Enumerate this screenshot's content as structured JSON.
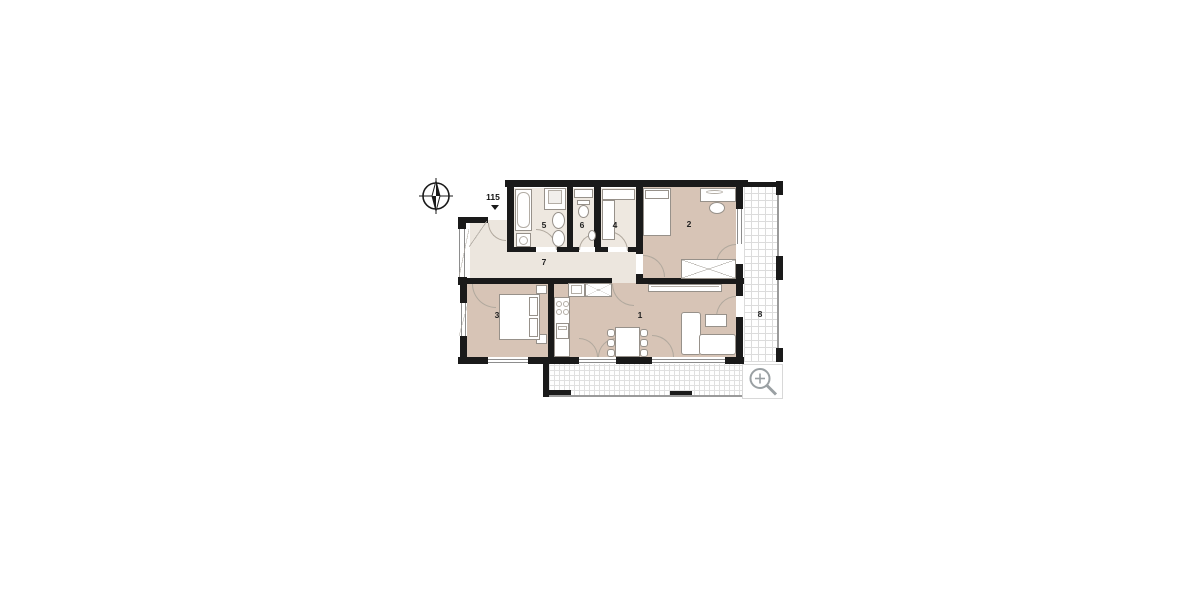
{
  "page": {
    "type": "apartment floor plan drawing",
    "background": "#ffffff"
  },
  "unit": {
    "number": "115"
  },
  "rooms": [
    {
      "key": "living-room",
      "label": "1"
    },
    {
      "key": "bedroom-main",
      "label": "2"
    },
    {
      "key": "bedroom-second",
      "label": "3"
    },
    {
      "key": "walk-in-closet",
      "label": "4"
    },
    {
      "key": "bathroom",
      "label": "5"
    },
    {
      "key": "wc",
      "label": "6"
    },
    {
      "key": "hallway",
      "label": "7"
    },
    {
      "key": "balcony",
      "label": "8"
    }
  ],
  "icons": {
    "compass": "north-compass",
    "zoom": "magnifier-plus"
  },
  "colors": {
    "wall": "#1a1a1a",
    "room_warm": "#d7c4b6",
    "room_light": "#ece6de",
    "grid_line": "#dcdcdc",
    "icon_gray": "#9aa0a3"
  }
}
